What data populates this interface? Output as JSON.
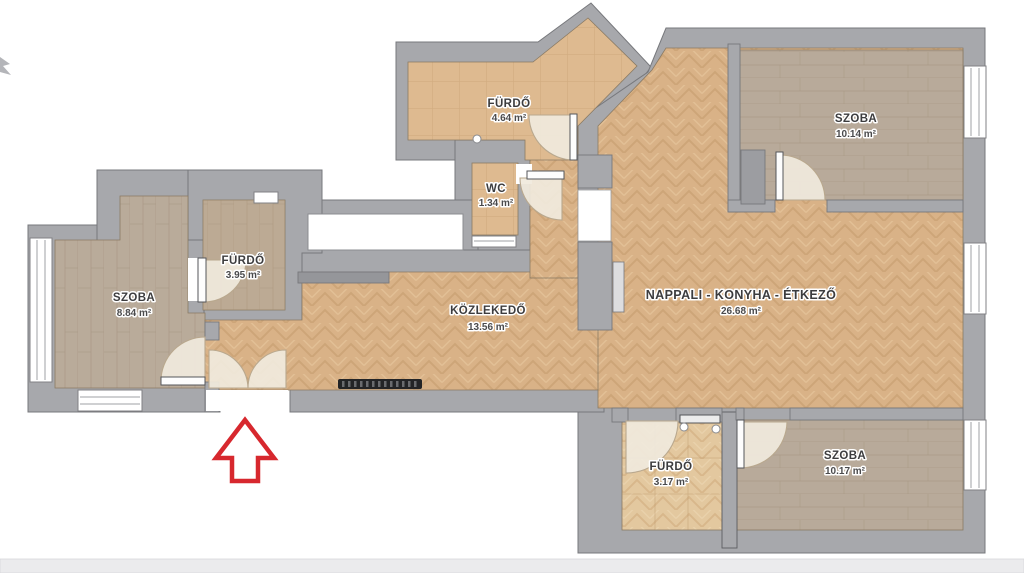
{
  "plan": {
    "title": "Apartment floor plan",
    "rooms": [
      {
        "id": "furdo-top",
        "name": "FÜRDŐ",
        "area": "4.64 m²"
      },
      {
        "id": "wc",
        "name": "WC",
        "area": "1.34 m²"
      },
      {
        "id": "szoba-topright",
        "name": "SZOBA",
        "area": "10.14 m²"
      },
      {
        "id": "furdo-left",
        "name": "FÜRDŐ",
        "area": "3.95 m²"
      },
      {
        "id": "szoba-left",
        "name": "SZOBA",
        "area": "8.84 m²"
      },
      {
        "id": "kozlekedo",
        "name": "KÖZLEKEDŐ",
        "area": "13.56 m²"
      },
      {
        "id": "nappali",
        "name": "NAPPALI - KONYHA - ÉTKEZŐ",
        "area": "26.68 m²"
      },
      {
        "id": "furdo-bottom",
        "name": "FÜRDŐ",
        "area": "3.17 m²"
      },
      {
        "id": "szoba-bottomright",
        "name": "SZOBA",
        "area": "10.17 m²"
      }
    ],
    "colors": {
      "wall": "#a7a8ac",
      "wall_outline": "#77787c",
      "parquet": "#d9b287",
      "plank": "#b8aa9a",
      "tile": "#deba90",
      "door_swing": "#f0e9dd",
      "entry_arrow": "#d7282e"
    }
  }
}
